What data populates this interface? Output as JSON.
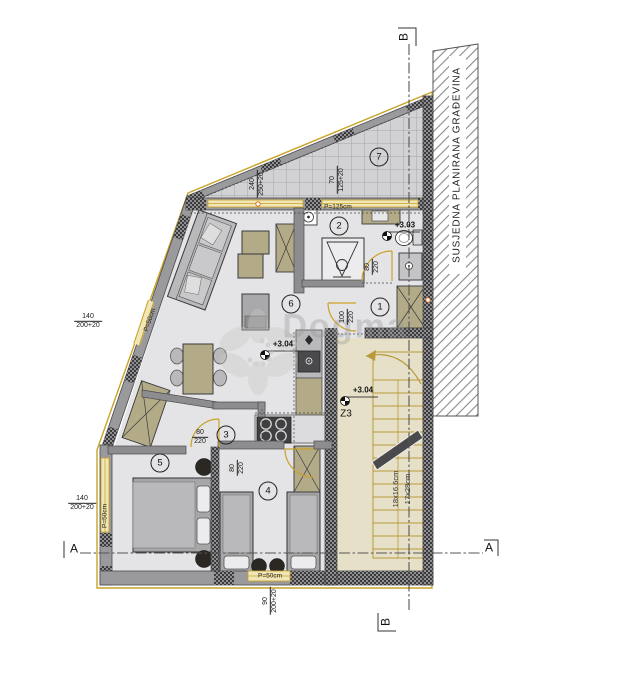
{
  "plan": {
    "neighbor_label": "SUSJEDNA PLANIRANA GRAĐEVINA",
    "watermark": "Dogma",
    "rooms": {
      "r1": "1",
      "r2": "2",
      "r3": "3",
      "r4": "4",
      "r5": "5",
      "r6": "6",
      "r7": "7"
    },
    "levels": {
      "bath": "+3.03",
      "living": "+3.04",
      "stair": "+3.04"
    },
    "stair": {
      "zone": "Z3",
      "risers": "18x16.6cm",
      "treads": "17x28cm"
    },
    "sections": {
      "a_left": "A",
      "a_right": "A",
      "b_top": "B",
      "b_bottom": "B"
    },
    "dims": {
      "terrace_w_a": "240",
      "terrace_w_b": "250+20",
      "terrace_e_a": "70",
      "terrace_e_b": "125+20",
      "parapet_top": "P=125cm",
      "door_bath_a": "80",
      "door_bath_b": "220",
      "door_hall_a": "100",
      "door_hall_b": "220",
      "door_r5_a": "80",
      "door_r5_b": "220",
      "door_r4_a": "80",
      "door_r4_b": "220",
      "win_lu_a": "140",
      "win_lu_b": "200+20",
      "win_ll_a": "140",
      "win_ll_b": "200+20",
      "win_bot_a": "90",
      "win_bot_b": "200+20",
      "parapet_lu": "P=50cm",
      "parapet_ll": "P=50cm",
      "parapet_bot": "P=50cm"
    },
    "colors": {
      "accent_gold": "#c9a227",
      "wall_dark": "#4a4a4c",
      "floor_gray": "#e4e4e6",
      "stair_floor": "#e7e0c8",
      "furniture_tan": "#b3ab88"
    }
  }
}
